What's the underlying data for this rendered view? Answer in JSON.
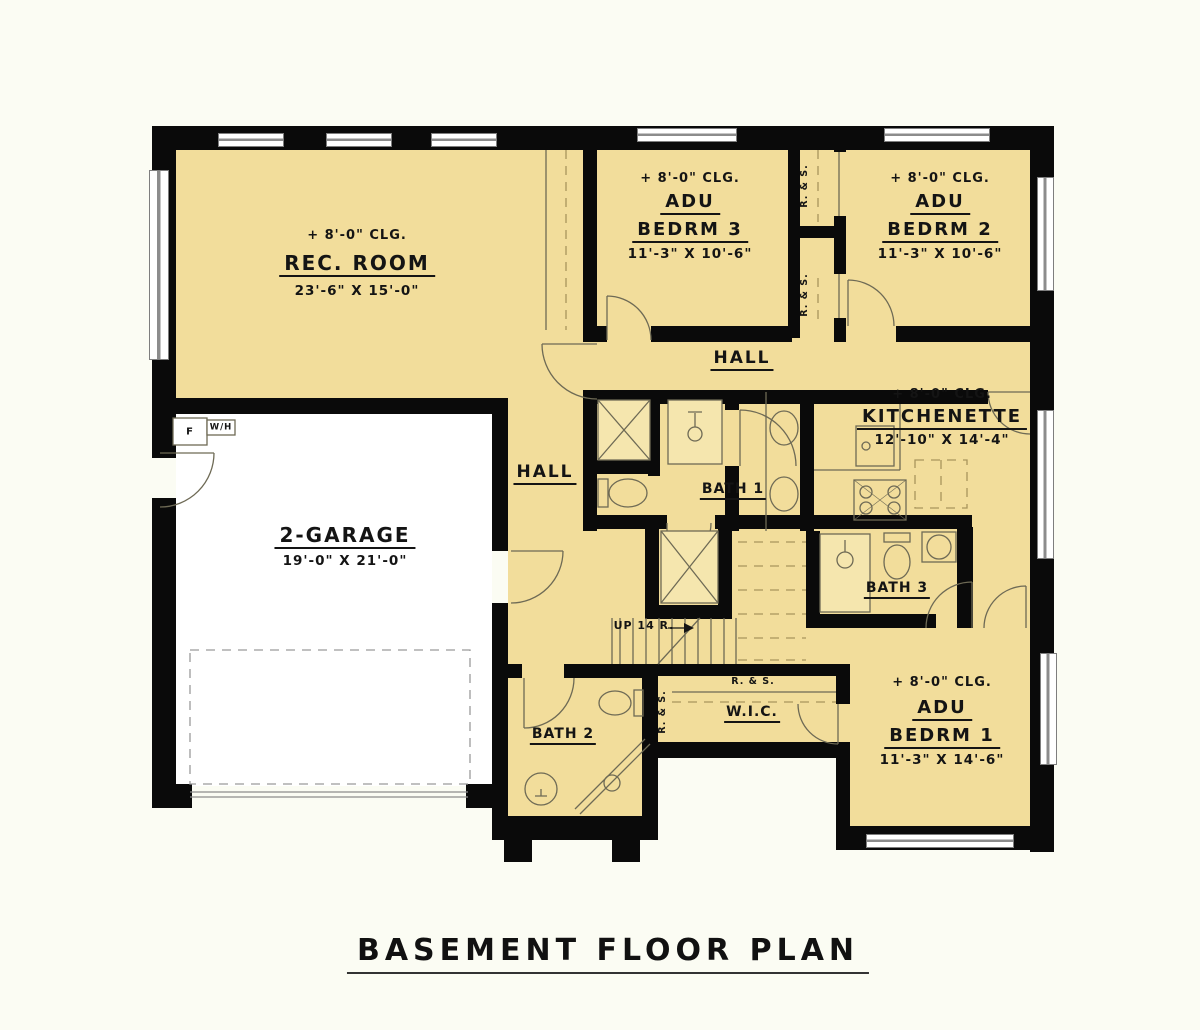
{
  "title": "BASEMENT FLOOR PLAN",
  "colors": {
    "bg": "#fbfcf3",
    "floor": "#F2DD9B",
    "garage_floor": "#ffffff",
    "wall": "#0a0a0a",
    "line": "#6e6a55"
  },
  "rooms": {
    "rec_room": {
      "ceiling": "+ 8'-0\" CLG.",
      "name": "REC. ROOM",
      "dims": "23'-6\" X 15'-0\""
    },
    "adu_bedrm3": {
      "ceiling": "+ 8'-0\" CLG.",
      "adu": "ADU",
      "name": "BEDRM 3",
      "dims": "11'-3\" X 10'-6\""
    },
    "adu_bedrm2": {
      "ceiling": "+ 8'-0\" CLG.",
      "adu": "ADU",
      "name": "BEDRM 2",
      "dims": "11'-3\" X 10'-6\""
    },
    "adu_bedrm1": {
      "ceiling": "+ 8'-0\" CLG.",
      "adu": "ADU",
      "name": "BEDRM 1",
      "dims": "11'-3\" X 14'-6\""
    },
    "kitchenette": {
      "ceiling": "+ 8'-0\" CLG.",
      "name": "KITCHENETTE",
      "dims": "12'-10\" X 14'-4\""
    },
    "garage": {
      "name": "2-GARAGE",
      "dims": "19'-0\" X 21'-0\""
    },
    "hall_upper": {
      "name": "HALL"
    },
    "hall_lower": {
      "name": "HALL"
    },
    "bath1": {
      "name": "BATH 1"
    },
    "bath2": {
      "name": "BATH 2"
    },
    "bath3": {
      "name": "BATH 3"
    },
    "wic": {
      "name": "W.I.C."
    }
  },
  "annotations": {
    "stairs": "UP 14 R.",
    "rod_shelf": "R. & S.",
    "furnace": "F",
    "water_heater": "W/H"
  }
}
